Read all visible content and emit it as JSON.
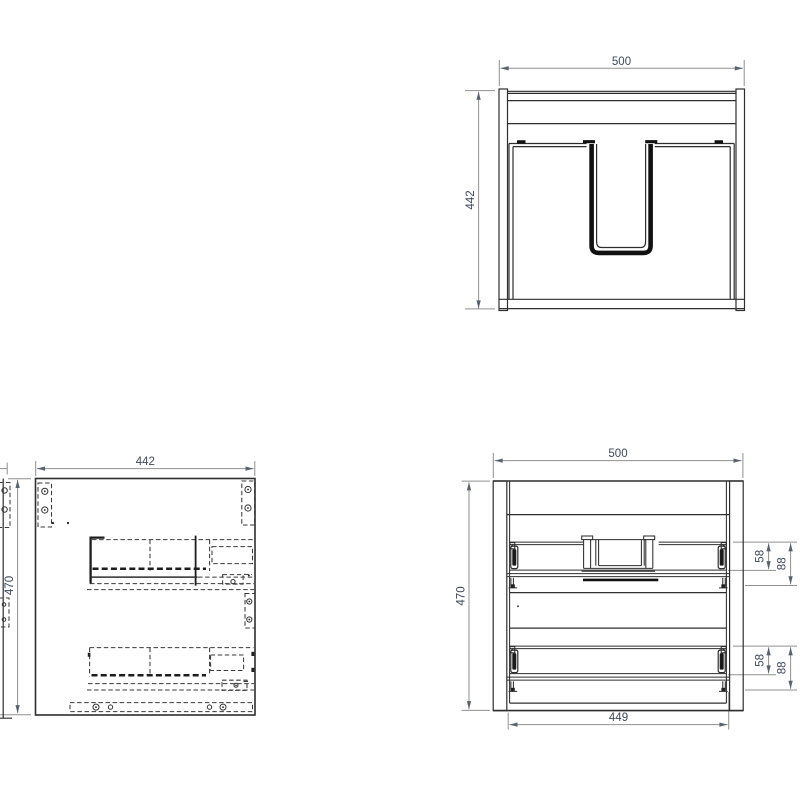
{
  "drawing": {
    "type": "cabinet-orthographic-views",
    "views": {
      "plan": {
        "name": "top view",
        "width": "500",
        "height": "442"
      },
      "side": {
        "name": "side view",
        "width": "442",
        "height": "470"
      },
      "front": {
        "name": "front view",
        "width": "500",
        "height": "470",
        "inner_width": "449",
        "upper_drawer": {
          "side_height": "58",
          "total_height": "88"
        },
        "lower_drawer": {
          "side_height": "58",
          "total_height": "88"
        }
      }
    },
    "colors": {
      "background": "#ffffff",
      "object_line": "#2e2e2e",
      "hidden_line": "#3a3a3a",
      "dimension_line": "#909090",
      "dimension_text": "#3f4857"
    }
  }
}
